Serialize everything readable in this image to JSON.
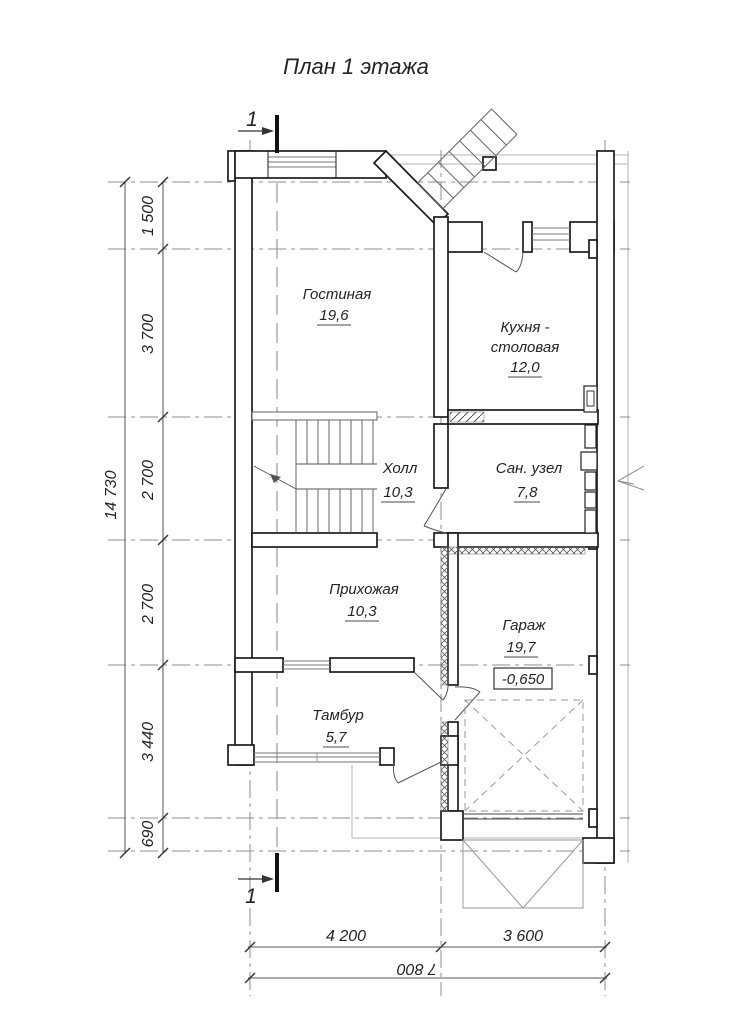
{
  "title": "План 1 этажа",
  "section": {
    "label": "1"
  },
  "rooms": {
    "living": {
      "name": "Гостиная",
      "area": "19,6"
    },
    "kitchen": {
      "name_line1": "Кухня -",
      "name_line2": "столовая",
      "area": "12,0"
    },
    "hall": {
      "name": "Холл",
      "area": "10,3"
    },
    "bathroom": {
      "name": "Сан. узел",
      "area": "7,8"
    },
    "entry": {
      "name": "Прихожая",
      "area": "10,3"
    },
    "garage": {
      "name": "Гараж",
      "area": "19,7",
      "elevation": "-0,650"
    },
    "vestibule": {
      "name": "Тамбур",
      "area": "5,7"
    }
  },
  "dimensions": {
    "left": {
      "total": "14 730",
      "chain": [
        "1 500",
        "3 700",
        "2 700",
        "2 700",
        "3 440",
        "690"
      ]
    },
    "bottom": {
      "total": "7 800",
      "chain": [
        "4 200",
        "3 600"
      ]
    }
  },
  "colors": {
    "wall": "#1c1c1c",
    "thin_gray": "#9a9a9a",
    "text": "#242424"
  }
}
